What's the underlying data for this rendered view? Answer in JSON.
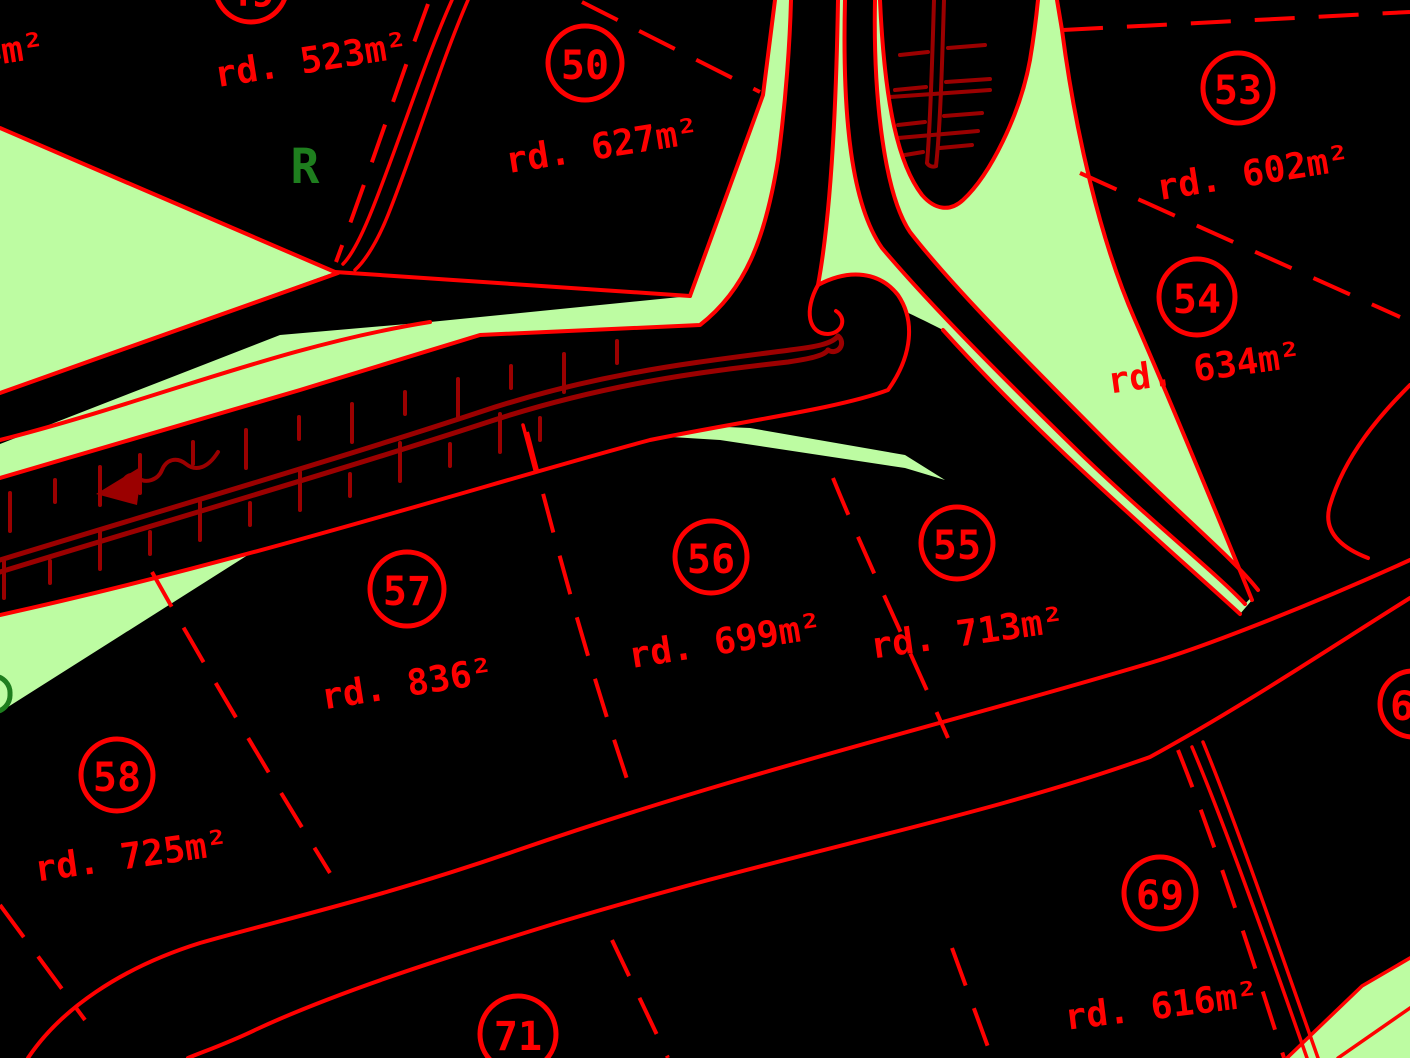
{
  "view": {
    "type": "cadastral-parcel-plan",
    "width_px": 1410,
    "height_px": 1058,
    "colors": {
      "background": "#000000",
      "open_land": "#BDFCA2",
      "parcel_boundary": "#FF0000",
      "terrain_detail": "#9B0000",
      "labels": "#FF0000",
      "vegetation_mark": "#1E7E1E"
    }
  },
  "lots": [
    {
      "number": "49",
      "area": "rd. 523m²"
    },
    {
      "number": "50",
      "area": "rd. 627m²"
    },
    {
      "number": "53",
      "area": "rd. 602m²"
    },
    {
      "number": "54",
      "area": "rd. 634m²"
    },
    {
      "number": "55",
      "area": "rd. 713m²"
    },
    {
      "number": "56",
      "area": "rd. 699m²"
    },
    {
      "number": "57",
      "area": "rd. 836²"
    },
    {
      "number": "58",
      "area": "rd. 725m²"
    },
    {
      "number": "69",
      "area": "rd. 616m²"
    },
    {
      "number": "71",
      "area": ""
    },
    {
      "number": "6",
      "area": ""
    }
  ],
  "fragments": {
    "top_left_area": "4m²",
    "reserve_letter": "R"
  }
}
